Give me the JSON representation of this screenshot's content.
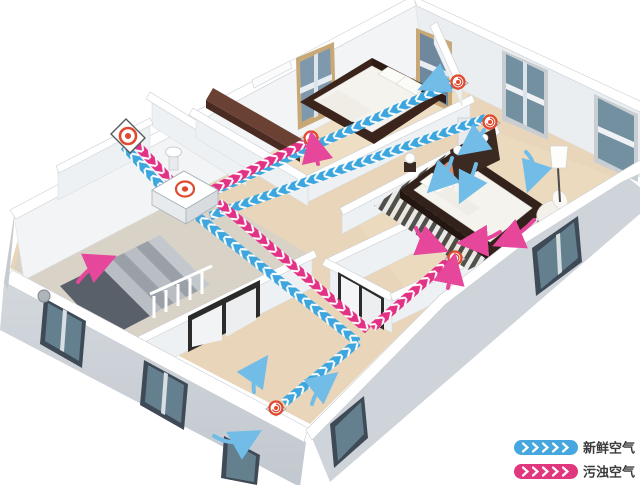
{
  "legend": {
    "items": [
      {
        "id": "fresh-air",
        "label": "新鲜空气",
        "color": "#45A7DD"
      },
      {
        "id": "exhaust-air",
        "label": "污浊空气",
        "color": "#E0377E"
      }
    ]
  },
  "colors": {
    "fresh_duct": "#3EA6DE",
    "exhaust_duct": "#E23286",
    "fresh_arrow": "#72BCE8",
    "exhaust_arrow": "#E6479B",
    "diffuser_red": "#DF4A2E",
    "floor_beige": "#E9D6BA",
    "wall_face": "#CDD2D8"
  },
  "icons": {
    "ventilation_unit": "hrv-box-with-red-rings",
    "outdoor_vent": "wall-panel-red-ring",
    "supply_diffuser": "red-ring-diffuser",
    "exhaust_vent": "red-ring-diffuser",
    "duct_fresh": "blue-chevron-duct",
    "duct_exhaust": "pink-chevron-duct"
  }
}
